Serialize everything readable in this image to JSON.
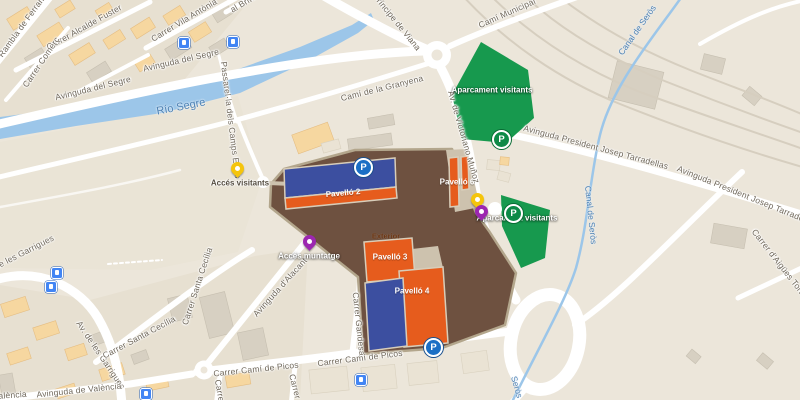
{
  "colors": {
    "bg": "#ece6da",
    "zone": "#e7e0d1",
    "park": "#eae4d6",
    "water": "#9cc6e9",
    "water-label": "#4e82b4",
    "road": "#ffffff",
    "rail": "#d6cebf",
    "building-gray": "#d7d0c2",
    "building-orange": "#f6d7a0",
    "building-orange-stroke": "#e5bd82",
    "green": "#17994e",
    "venue": "#6e5140",
    "venue-edge": "#b3a68c",
    "pad": "#cdc2ae",
    "pav-orange": "#e65c1d",
    "pav-blue": "#3c4fa0",
    "pin-yellow": "#f5c50c",
    "pin-purple": "#9c27b0",
    "p-blue": "#1b6fc5",
    "p-green": "#0d8a47",
    "transit": "#4285f4",
    "street-label": "#6f675a"
  },
  "labels": {
    "rambla": "Rambla de Ferran",
    "fuster": "Carrer Alcalde Fuster",
    "comerc": "Carrer Comerç",
    "vila_antonia": "Carrer Vila Antònia",
    "brito": "al Brito",
    "segre_ave_1": "Avinguda del Segre",
    "segre_ave_2": "Avinguda del Segre",
    "principe": "Príncipe de Viana",
    "cami_municipal": "Camí Municipal",
    "granyena": "Camí de la Granyena",
    "victoriano": "Av. de Victoriano Muñoz",
    "tarradellas_1": "Avinguda President Josep Tarradellas",
    "tarradellas_2": "Avinguda President Josep Tarradellas",
    "aigues": "Carrer d'Aigües Tortes",
    "passarella": "Passarel·la dels Camps Elisis",
    "garrigues_1": "de les Garrigues",
    "garrigues_2": "Av. de les Garrigues",
    "valencia_1": "València",
    "valencia_2": "Avinguda de València",
    "santa_cecilia_1": "Carrer Santa Cecília",
    "santa_cecilia_2": "Carrer Santa Cecília",
    "alacant": "Avinguda d'Alacant",
    "gandesa": "Carrer Gandesa",
    "picos_1": "Carrer Camí de Picos",
    "picos_2": "Carrer Camí de Picos",
    "carrer_frag_1": "Carrer",
    "carrer_frag_2": "Carrer d"
  },
  "water": {
    "river": "Río Segre",
    "canal_1": "Canal de Seròs",
    "canal_2": "Canal de Seròs",
    "canal_3": "Seròs"
  },
  "venue": {
    "pavello2": "Pavelló 2",
    "pavello3": "Pavelló 3",
    "pavello4": "Pavelló 4",
    "pavello6": "Pavelló 6",
    "exterior": "Exterior"
  },
  "poi": {
    "aparcament_top": "Aparcament visitants",
    "aparcament_right": "Aparcament visitants",
    "acces_visitants": "Accés visitants",
    "acces_muntatge": "Accés muntatge"
  },
  "icons": {
    "parking_letter": "P"
  }
}
